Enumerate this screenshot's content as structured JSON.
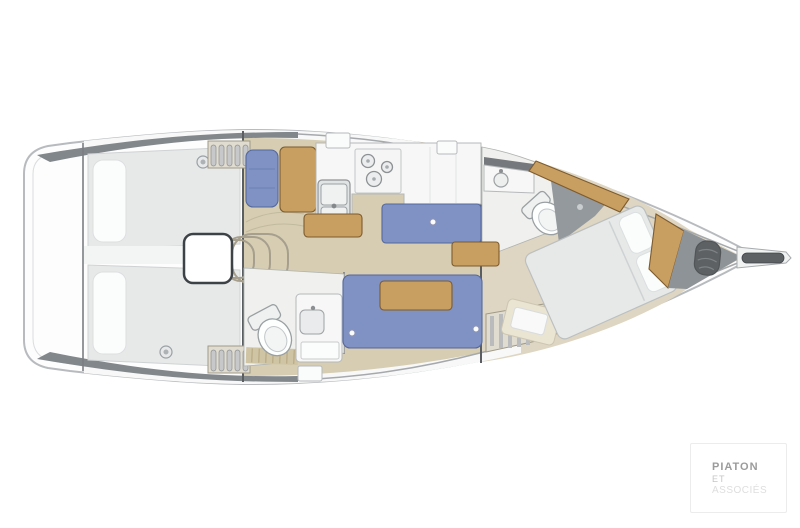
{
  "watermark": {
    "line1": "PIATON",
    "line2": "ET",
    "line3": "ASSOCIÉS"
  },
  "colors": {
    "page_bg": "#ffffff",
    "hull_fill": "#fdfdfd",
    "rim_dark": "#82878c",
    "deck_white": "#f7f8f7",
    "floor_tan": "#d6cdb2",
    "floor_fwd": "#ded6c2",
    "bed_gray": "#e7e9e9",
    "pillow_white": "#fbfcfc",
    "settee_blue": "#8092c3",
    "wood": "#c99e61",
    "counter_white": "#f6f7f6",
    "steel_gray": "#e1e4e5",
    "head_floor": "#f0f1ee",
    "shower_gray": "#94999d",
    "bow_gray": "#8e9397",
    "anchor_dark": "#5d6164",
    "locker_bg": "#e0dcd0"
  }
}
